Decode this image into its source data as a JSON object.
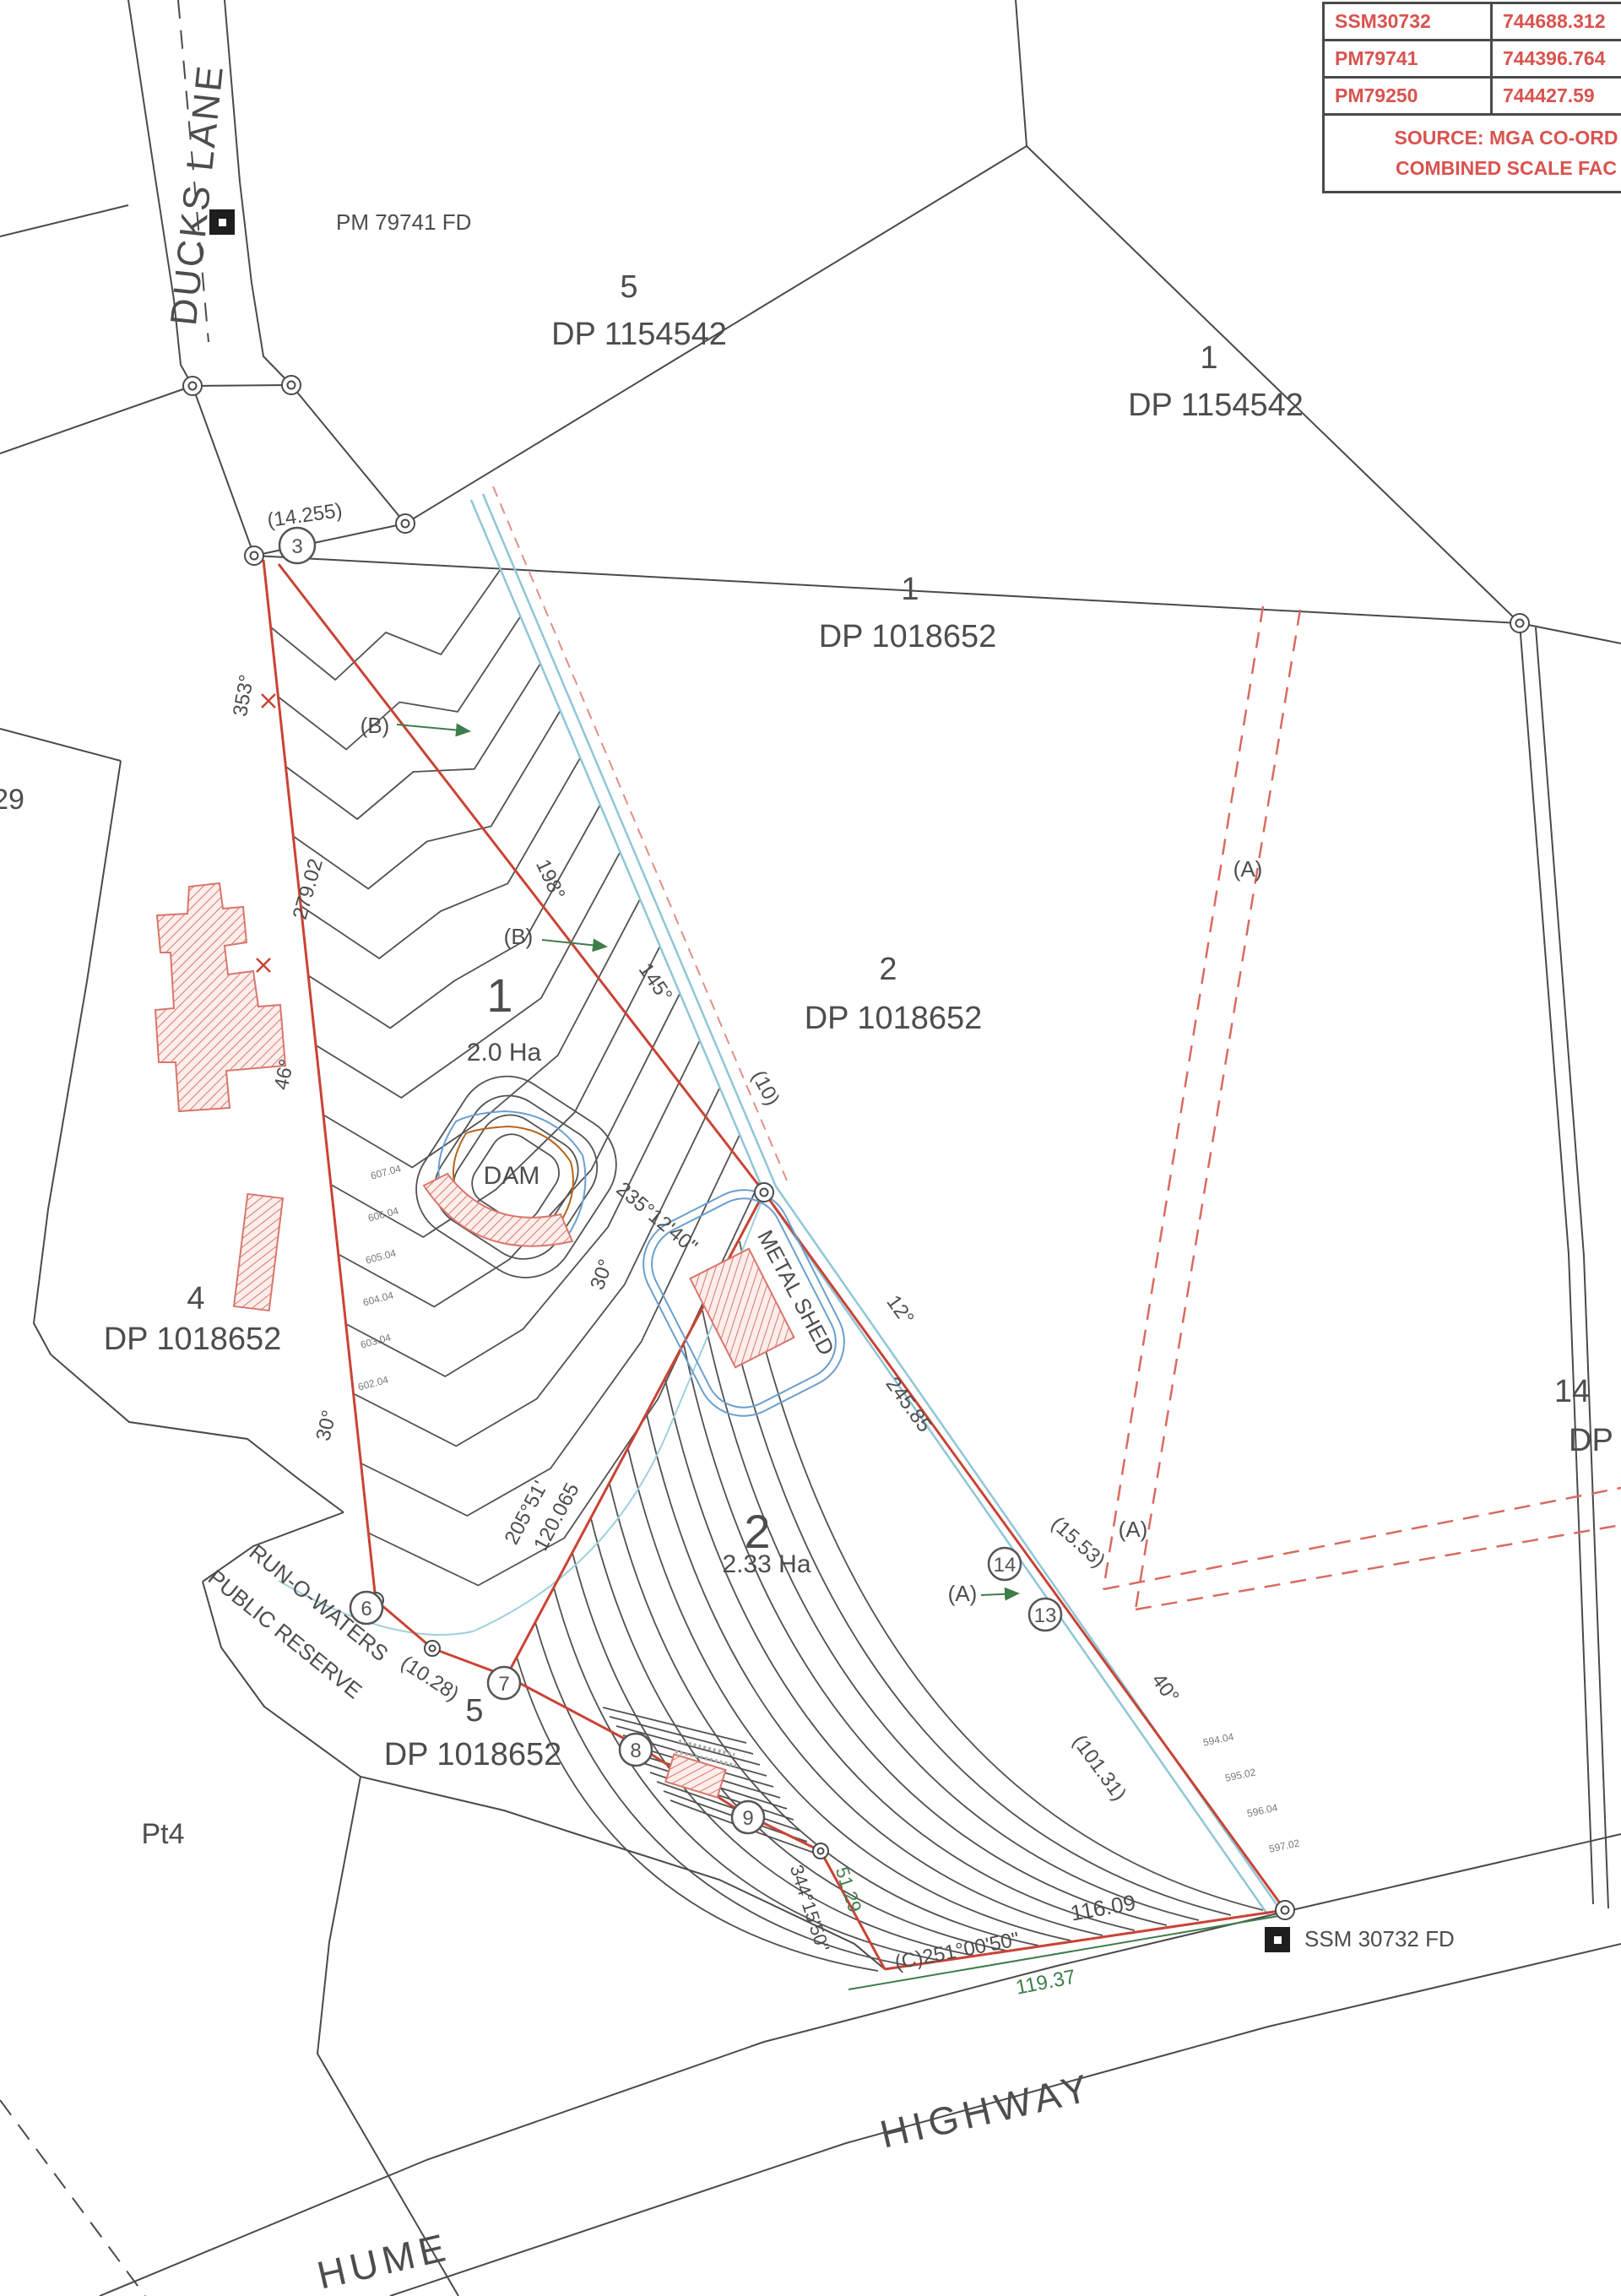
{
  "coordinate_table": {
    "rows": [
      [
        "SSM30732",
        "744688.312"
      ],
      [
        "PM79741",
        "744396.764"
      ],
      [
        "PM79250",
        "744427.59"
      ]
    ],
    "note_line1": "SOURCE: MGA CO-ORD",
    "note_line2": "COMBINED SCALE FAC",
    "text_color": "#d9534f"
  },
  "roads": {
    "ducks_lane": "DUCKS LANE",
    "hume": "HUME",
    "highway": "HIGHWAY"
  },
  "monuments": {
    "pm": "PM 79741 FD",
    "ssm": "SSM 30732 FD"
  },
  "parcels": [
    {
      "lot": "5",
      "dp": "DP 1154542"
    },
    {
      "lot": "1",
      "dp": "DP 1154542"
    },
    {
      "lot": "1",
      "dp": "DP 1018652"
    },
    {
      "lot": "2",
      "dp": "DP 1018652"
    },
    {
      "lot": "4",
      "dp": "DP 1018652"
    },
    {
      "lot": "5",
      "dp": "DP 1018652"
    },
    {
      "lot": "14",
      "dp": "DP 11025"
    },
    {
      "lot": "Pt4",
      "dp": ""
    },
    {
      "lot": "29",
      "dp": ""
    }
  ],
  "subject_lots": [
    {
      "num": "1",
      "area": "2.0 Ha"
    },
    {
      "num": "2",
      "area": "2.33 Ha"
    }
  ],
  "features": {
    "dam": "DAM",
    "shed": "METAL SHED",
    "reserve1": "RUN-O-WATERS",
    "reserve2": "PUBLIC RESERVE"
  },
  "survey_points": [
    "3",
    "6",
    "7",
    "8",
    "9",
    "13",
    "14"
  ],
  "annotations": [
    {
      "text": "(14.255)"
    },
    {
      "text": "353°"
    },
    {
      "text": "279.02"
    },
    {
      "text": "46°"
    },
    {
      "text": "(B)"
    },
    {
      "text": "(B)"
    },
    {
      "text": "198°"
    },
    {
      "text": "145°"
    },
    {
      "text": "(10)"
    },
    {
      "text": "235°12'40\""
    },
    {
      "text": "30°"
    },
    {
      "text": "12°"
    },
    {
      "text": "245.85"
    },
    {
      "text": "(15.53)"
    },
    {
      "text": "(A)"
    },
    {
      "text": "(A)"
    },
    {
      "text": "(A)"
    },
    {
      "text": "40°"
    },
    {
      "text": "(101.31)"
    },
    {
      "text": "205°51'"
    },
    {
      "text": "120.065"
    },
    {
      "text": "(10.28)"
    },
    {
      "text": "344°15'50\""
    },
    {
      "text": "51.29"
    },
    {
      "text": "116.09"
    },
    {
      "text": "(C)251°00'50\""
    },
    {
      "text": "119.37"
    },
    {
      "text": "30°"
    }
  ],
  "contour_labels": [
    "607.04",
    "606.04",
    "605.04",
    "604.04",
    "603.04",
    "602.04",
    "594.04",
    "595.02",
    "596.04",
    "597.02"
  ]
}
